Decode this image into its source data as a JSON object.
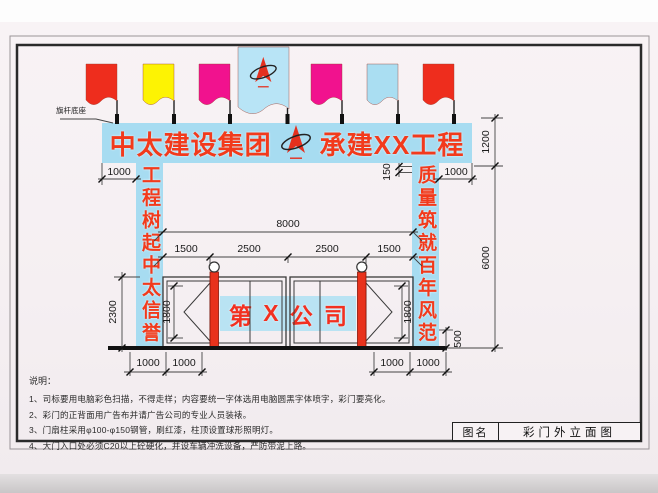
{
  "banner": {
    "left": "中太建设集团",
    "right": "承建XX工程"
  },
  "columns": {
    "left": "工程树起中太信誉",
    "right": "质量筑就百年风范"
  },
  "gate_sign": [
    "第",
    "X",
    "公",
    "司"
  ],
  "labels": {
    "flag_base": "旗杆底座"
  },
  "dims": {
    "overhang_left": "1000",
    "overhang_right": "1000",
    "beam_offset": "150",
    "banner_height": "1200",
    "column_height": "6000",
    "base_height": "500",
    "opening_width": "8000",
    "segments": [
      "1500",
      "2500",
      "2500",
      "1500"
    ],
    "gate_height": "2300",
    "panel_height_left": "1800",
    "panel_height_right": "1800",
    "bottom_left": [
      "1000",
      "1000"
    ],
    "bottom_right": [
      "1000",
      "1000"
    ]
  },
  "notes": {
    "heading": "说明：",
    "items": [
      "1、司标要用电脑彩色扫描，不得走样；内容要统一字体选用电脑圆黑字体喷字，彩门要亮化。",
      "2、彩门的正背面用广告布并请广告公司的专业人员装裱。",
      "3、门扇柱采用φ100-φ150钢管，刷红漆，柱顶设置球形照明灯。",
      "4、大门入口处必须C20以上砼硬化，并设车辆冲洗设备，严防带泥上路。"
    ]
  },
  "title_block": {
    "label": "图名",
    "value": "彩门外立面图"
  },
  "flags": {
    "colors": [
      "#ee2d1d",
      "#fdf303",
      "#f1128e",
      "#b8e4f6",
      "#f1128e",
      "#aadef2",
      "#ee2d1d"
    ]
  },
  "colors": {
    "board_blue": "#a7dcf1",
    "sign_band_blue": "#b9e3f3",
    "brand_red_text": "#f23a1c",
    "post_red": "#e8321c",
    "flag_red": "#ee2d1d",
    "flag_yellow": "#fdf303",
    "flag_magenta": "#f1128e",
    "flag_light_blue": "#aadef2",
    "drawing_line": "#333333",
    "page_background": "#f5eff2"
  }
}
